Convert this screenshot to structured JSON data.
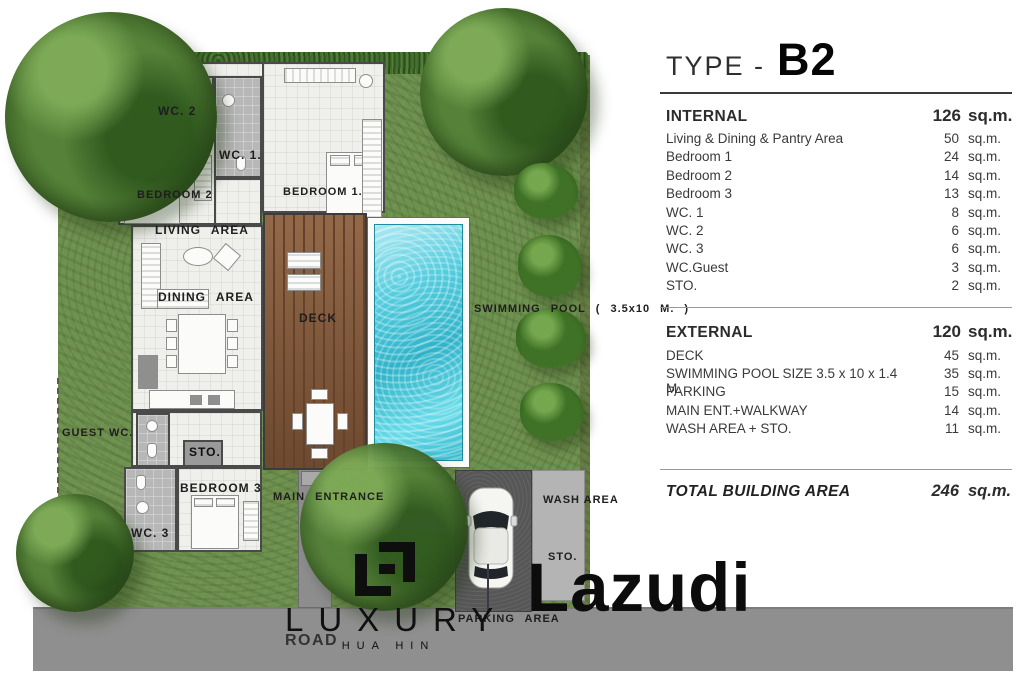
{
  "header": {
    "title_prefix": "TYPE -",
    "title_type": "B2"
  },
  "internal": {
    "heading": "INTERNAL",
    "total_value": "126",
    "total_unit": "sq.m.",
    "rows": [
      {
        "label": "Living & Dining  & Pantry Area",
        "value": "50",
        "unit": "sq.m."
      },
      {
        "label": "Bedroom  1",
        "value": "24",
        "unit": "sq.m."
      },
      {
        "label": "Bedroom  2",
        "value": "14",
        "unit": "sq.m."
      },
      {
        "label": "Bedroom  3",
        "value": "13",
        "unit": "sq.m."
      },
      {
        "label": "WC. 1",
        "value": "8",
        "unit": "sq.m."
      },
      {
        "label": "WC. 2",
        "value": "6",
        "unit": "sq.m."
      },
      {
        "label": "WC. 3",
        "value": "6",
        "unit": "sq.m."
      },
      {
        "label": "WC.Guest",
        "value": "3",
        "unit": "sq.m."
      },
      {
        "label": "STO.",
        "value": "2",
        "unit": "sq.m."
      }
    ]
  },
  "external": {
    "heading": "EXTERNAL",
    "total_value": "120",
    "total_unit": "sq.m.",
    "rows": [
      {
        "label": "DECK",
        "value": "45",
        "unit": "sq.m."
      },
      {
        "label": "SWIMMING  POOL  SIZE 3.5 x 10 x 1.4 M.",
        "value": "35",
        "unit": "sq.m."
      },
      {
        "label": "PARKING",
        "value": "15",
        "unit": "sq.m."
      },
      {
        "label": "MAIN ENT.+WALKWAY",
        "value": "14",
        "unit": "sq.m."
      },
      {
        "label": "WASH AREA + STO.",
        "value": "11",
        "unit": "sq.m."
      }
    ]
  },
  "total": {
    "label": "TOTAL BUILDING AREA",
    "value": "246",
    "unit": "sq.m."
  },
  "plan": {
    "labels": {
      "wc2": "WC. 2",
      "wc1": "WC. 1.",
      "bedroom2": "BEDROOM 2",
      "bedroom1": "BEDROOM 1.",
      "living": "LIVING AREA",
      "dining": "DINING AREA",
      "deck": "DECK",
      "pool": "SWIMMING POOL ( 3.5x10 M. )",
      "guest_wc": "GUEST WC.",
      "sto_house": "STO.",
      "bedroom3": "BEDROOM 3",
      "wc3": "WC. 3",
      "main_entrance": "MAIN ENTRANCE",
      "wash_area": "WASH AREA",
      "sto_outdoor": "STO.",
      "parking_area": "PARKING AREA",
      "road": "ROAD"
    },
    "watermark": "Lazudi",
    "logo": {
      "brand": "LUXURY",
      "location": "HUA HIN"
    },
    "colors": {
      "grass": "#6f9150",
      "pool_water": "#3cbcd0",
      "deck_wood": "#84593a",
      "road": "#8f8f8f",
      "parking": "#575757",
      "accent_text": "#1e1e1e"
    }
  }
}
